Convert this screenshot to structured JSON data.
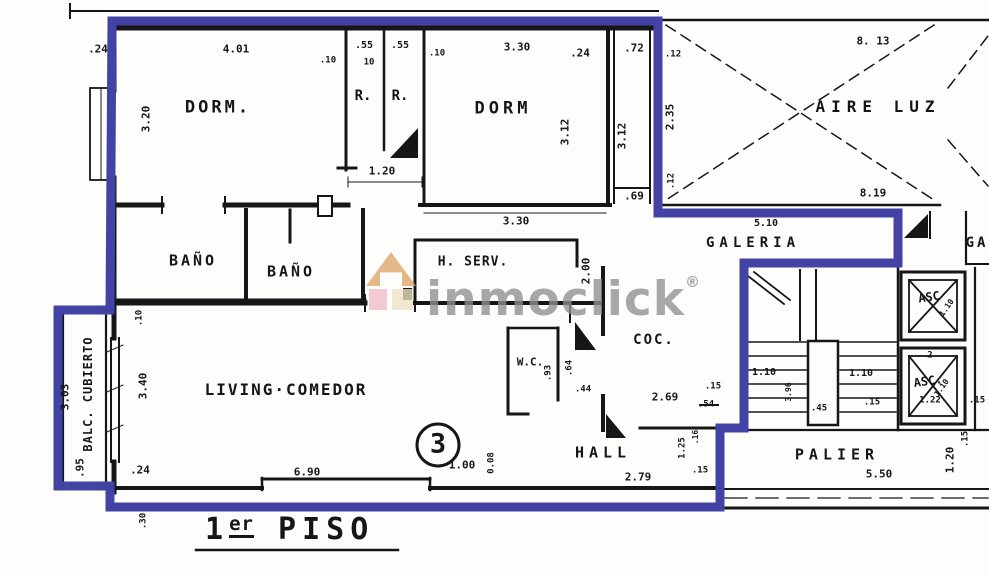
{
  "title": {
    "prefix": "1",
    "sup": "er",
    "main": "PISO"
  },
  "unit_number": "3",
  "watermark": {
    "brand": "inmoclick",
    "registered": "®"
  },
  "colors": {
    "outline_blue": "#4343a6",
    "ink": "#161616",
    "watermark_gray": "#8f8f8f",
    "logo_tan": "#dfa56b",
    "logo_pink": "#f2bcc7",
    "logo_cream": "#f0e2c4",
    "paper": "#fdfdfb"
  },
  "room_labels": [
    {
      "name": "dorm-1",
      "text": "DORM.",
      "x": 218,
      "y": 108,
      "size": 17,
      "ls": 3
    },
    {
      "name": "closet-r1",
      "text": "R.",
      "x": 363,
      "y": 96,
      "size": 14,
      "ls": 0
    },
    {
      "name": "closet-r2",
      "text": "R.",
      "x": 400,
      "y": 96,
      "size": 14,
      "ls": 0
    },
    {
      "name": "dorm-2",
      "text": "DORM",
      "x": 503,
      "y": 109,
      "size": 17,
      "ls": 4
    },
    {
      "name": "bano-1",
      "text": "BAÑO",
      "x": 193,
      "y": 261,
      "size": 15,
      "ls": 3
    },
    {
      "name": "bano-2",
      "text": "BAÑO",
      "x": 291,
      "y": 272,
      "size": 15,
      "ls": 3
    },
    {
      "name": "h-serv",
      "text": "H. SERV.",
      "x": 473,
      "y": 262,
      "size": 13,
      "ls": 1
    },
    {
      "name": "aire-luz",
      "text": "AIRE LUZ",
      "x": 878,
      "y": 107,
      "size": 16,
      "ls": 6
    },
    {
      "name": "galeria",
      "text": "GALERIA",
      "x": 753,
      "y": 243,
      "size": 14,
      "ls": 5
    },
    {
      "name": "galeria-adjacent",
      "text": "GA",
      "x": 977,
      "y": 243,
      "size": 14,
      "ls": 3
    },
    {
      "name": "cocina",
      "text": "COC.",
      "x": 654,
      "y": 340,
      "size": 14,
      "ls": 2
    },
    {
      "name": "wc",
      "text": "W.C.",
      "x": 530,
      "y": 362,
      "size": 11,
      "ls": 0
    },
    {
      "name": "hall",
      "text": "HALL",
      "x": 603,
      "y": 453,
      "size": 15,
      "ls": 5
    },
    {
      "name": "living-comedor",
      "text": "LIVING·COMEDOR",
      "x": 286,
      "y": 390,
      "size": 16,
      "ls": 2
    },
    {
      "name": "balc-cubierto",
      "text": "BALC. CUBIERTO",
      "x": 88,
      "y": 394,
      "size": 12,
      "ls": 1,
      "rot": -90
    },
    {
      "name": "palier",
      "text": "PALIER",
      "x": 837,
      "y": 455,
      "size": 15,
      "ls": 5
    },
    {
      "name": "asc-1",
      "text": "ASC",
      "x": 929,
      "y": 297,
      "size": 12,
      "ls": 0,
      "rot": -8
    },
    {
      "name": "asc-2",
      "text": "ASC.",
      "x": 928,
      "y": 381,
      "size": 12,
      "ls": 0,
      "rot": -8
    }
  ],
  "dim_labels": [
    {
      "text": ".24",
      "x": 98,
      "y": 49
    },
    {
      "text": "4.01",
      "x": 236,
      "y": 49
    },
    {
      "text": ".10",
      "x": 328,
      "y": 61,
      "size": 9
    },
    {
      "text": ".55",
      "x": 364,
      "y": 46,
      "size": 10
    },
    {
      "text": "10",
      "x": 369,
      "y": 63,
      "size": 9
    },
    {
      "text": ".55",
      "x": 400,
      "y": 46,
      "size": 10
    },
    {
      "text": ".10",
      "x": 437,
      "y": 54,
      "size": 9
    },
    {
      "text": "3.30",
      "x": 517,
      "y": 47
    },
    {
      "text": ".24",
      "x": 580,
      "y": 53
    },
    {
      "text": ".72",
      "x": 634,
      "y": 48
    },
    {
      "text": ".12",
      "x": 673,
      "y": 55,
      "size": 9
    },
    {
      "text": "8. 13",
      "x": 873,
      "y": 41
    },
    {
      "text": "3.20",
      "x": 146,
      "y": 119,
      "rot": -90
    },
    {
      "text": "3.12",
      "x": 565,
      "y": 132,
      "rot": -90
    },
    {
      "text": "3.12",
      "x": 622,
      "y": 136,
      "rot": -90
    },
    {
      "text": "2.35",
      "x": 670,
      "y": 117,
      "rot": -90
    },
    {
      "text": ".12",
      "x": 672,
      "y": 181,
      "rot": -90,
      "size": 9
    },
    {
      "text": "1.20",
      "x": 382,
      "y": 171
    },
    {
      "text": ".69",
      "x": 634,
      "y": 196
    },
    {
      "text": "3.30",
      "x": 516,
      "y": 221
    },
    {
      "text": "8.19",
      "x": 873,
      "y": 193
    },
    {
      "text": "5.10",
      "x": 766,
      "y": 224,
      "size": 10
    },
    {
      "text": "2.00",
      "x": 586,
      "y": 271,
      "rot": -90
    },
    {
      "text": ".10",
      "x": 140,
      "y": 318,
      "rot": -90,
      "size": 9
    },
    {
      "text": "3.40",
      "x": 143,
      "y": 386,
      "rot": -90
    },
    {
      "text": ".24",
      "x": 140,
      "y": 470
    },
    {
      "text": "3.03",
      "x": 65,
      "y": 397,
      "rot": -90
    },
    {
      "text": ".95",
      "x": 80,
      "y": 468,
      "rot": -90
    },
    {
      "text": "6.90",
      "x": 307,
      "y": 472
    },
    {
      "text": "0.08",
      "x": 492,
      "y": 463,
      "rot": -90,
      "size": 9
    },
    {
      "text": "1.00",
      "x": 462,
      "y": 465
    },
    {
      "text": "2.79",
      "x": 638,
      "y": 477
    },
    {
      "text": ".15",
      "x": 700,
      "y": 471,
      "size": 9
    },
    {
      "text": ".93",
      "x": 549,
      "y": 373,
      "rot": -90,
      "size": 9
    },
    {
      "text": ".64",
      "x": 570,
      "y": 368,
      "rot": -90,
      "size": 9
    },
    {
      "text": ".44",
      "x": 583,
      "y": 390,
      "size": 9
    },
    {
      "text": "2.69",
      "x": 665,
      "y": 397
    },
    {
      "text": ".15",
      "x": 713,
      "y": 387,
      "size": 9
    },
    {
      "text": ".54",
      "x": 706,
      "y": 405,
      "size": 9
    },
    {
      "text": "1.25",
      "x": 683,
      "y": 448,
      "rot": -90,
      "size": 9
    },
    {
      "text": ".16",
      "x": 696,
      "y": 437,
      "rot": -90,
      "size": 8
    },
    {
      "text": "1.10",
      "x": 764,
      "y": 373,
      "size": 10
    },
    {
      "text": "3.96",
      "x": 789,
      "y": 392,
      "rot": -90,
      "size": 8
    },
    {
      "text": ".45",
      "x": 819,
      "y": 409,
      "size": 9
    },
    {
      "text": "1.10",
      "x": 861,
      "y": 374,
      "size": 10
    },
    {
      "text": ".15",
      "x": 872,
      "y": 403,
      "size": 9
    },
    {
      "text": "1.10",
      "x": 947,
      "y": 308,
      "rot": -55,
      "size": 8
    },
    {
      "text": "2",
      "x": 930,
      "y": 356,
      "size": 9
    },
    {
      "text": "1.10",
      "x": 942,
      "y": 388,
      "rot": -55,
      "size": 8
    },
    {
      "text": "1.22",
      "x": 930,
      "y": 401,
      "size": 9
    },
    {
      "text": ".15",
      "x": 977,
      "y": 401,
      "size": 9
    },
    {
      "text": "5.50",
      "x": 879,
      "y": 474
    },
    {
      "text": "1.20",
      "x": 950,
      "y": 460,
      "rot": -90
    },
    {
      "text": ".15",
      "x": 966,
      "y": 439,
      "rot": -90,
      "size": 9
    },
    {
      "text": ".30",
      "x": 144,
      "y": 521,
      "rot": -90,
      "size": 9
    }
  ]
}
